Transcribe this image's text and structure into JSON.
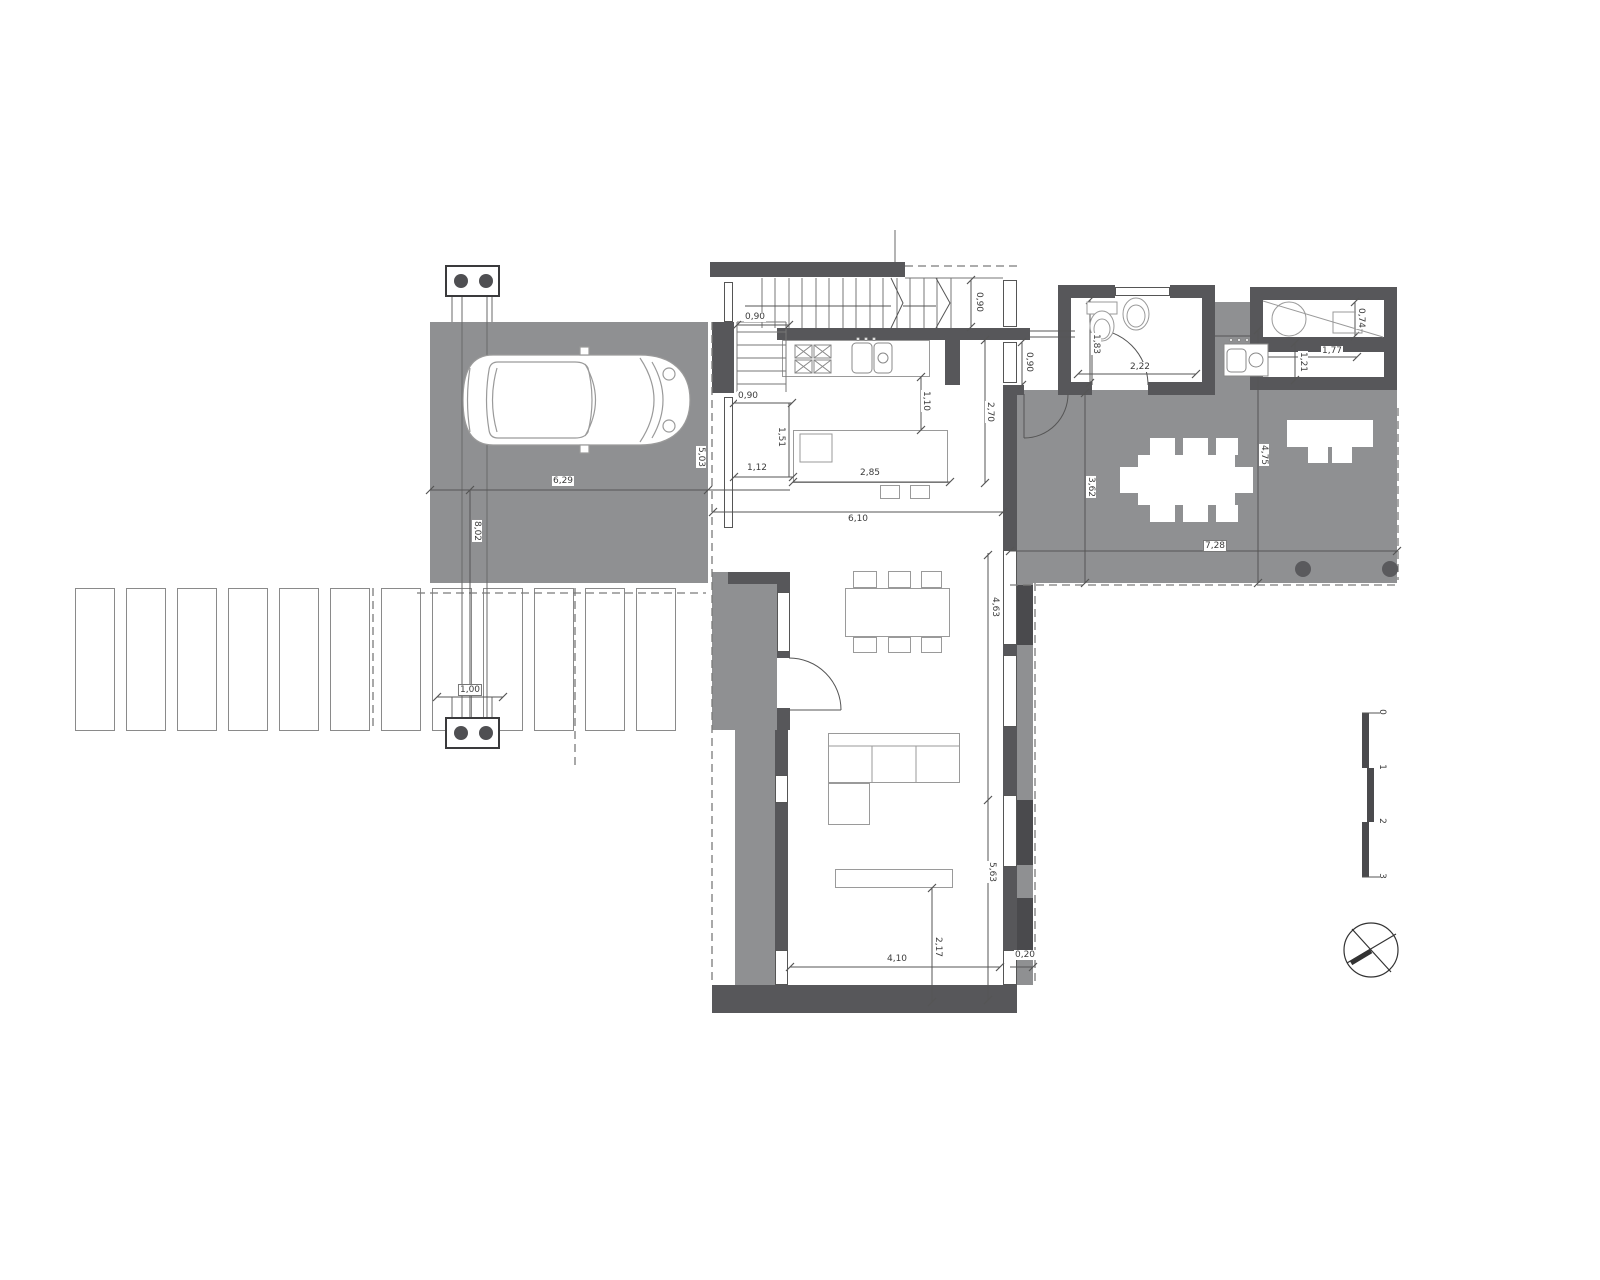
{
  "plan": {
    "colors": {
      "area_gray": "#8f9092",
      "wall_gray": "#57575a",
      "accent_dark": "#4a4a4d",
      "line_gray": "#555555"
    },
    "dims": {
      "stair_flight": "0,90",
      "stair_landing": "0,90",
      "kitchen_offset": "0,90",
      "hall_window": "0,90",
      "island_gap_x": "1,12",
      "island_gap_y": "1,51",
      "island_width": "2,85",
      "counter_island": "1,10",
      "kitchen_depth": "2,70",
      "kitchen_width": "6,10",
      "bath_width": "2,22",
      "bath_depth": "1,83",
      "store_shelf": "0,74",
      "store_width": "1,77",
      "store_depth": "1,21",
      "terrace_left": "3,62",
      "terrace_right": "4,75",
      "terrace_width": "7,28",
      "carport_width": "6,29",
      "carport_depth": "5,03",
      "drive_length": "8,02",
      "path_width": "1,00",
      "living_upper": "4,63",
      "living_lower": "5,63",
      "tv_wall": "2,17",
      "living_width": "4,10",
      "corner_offset": "0,20"
    },
    "scale_labels": [
      "0",
      "1",
      "2",
      "3"
    ]
  }
}
